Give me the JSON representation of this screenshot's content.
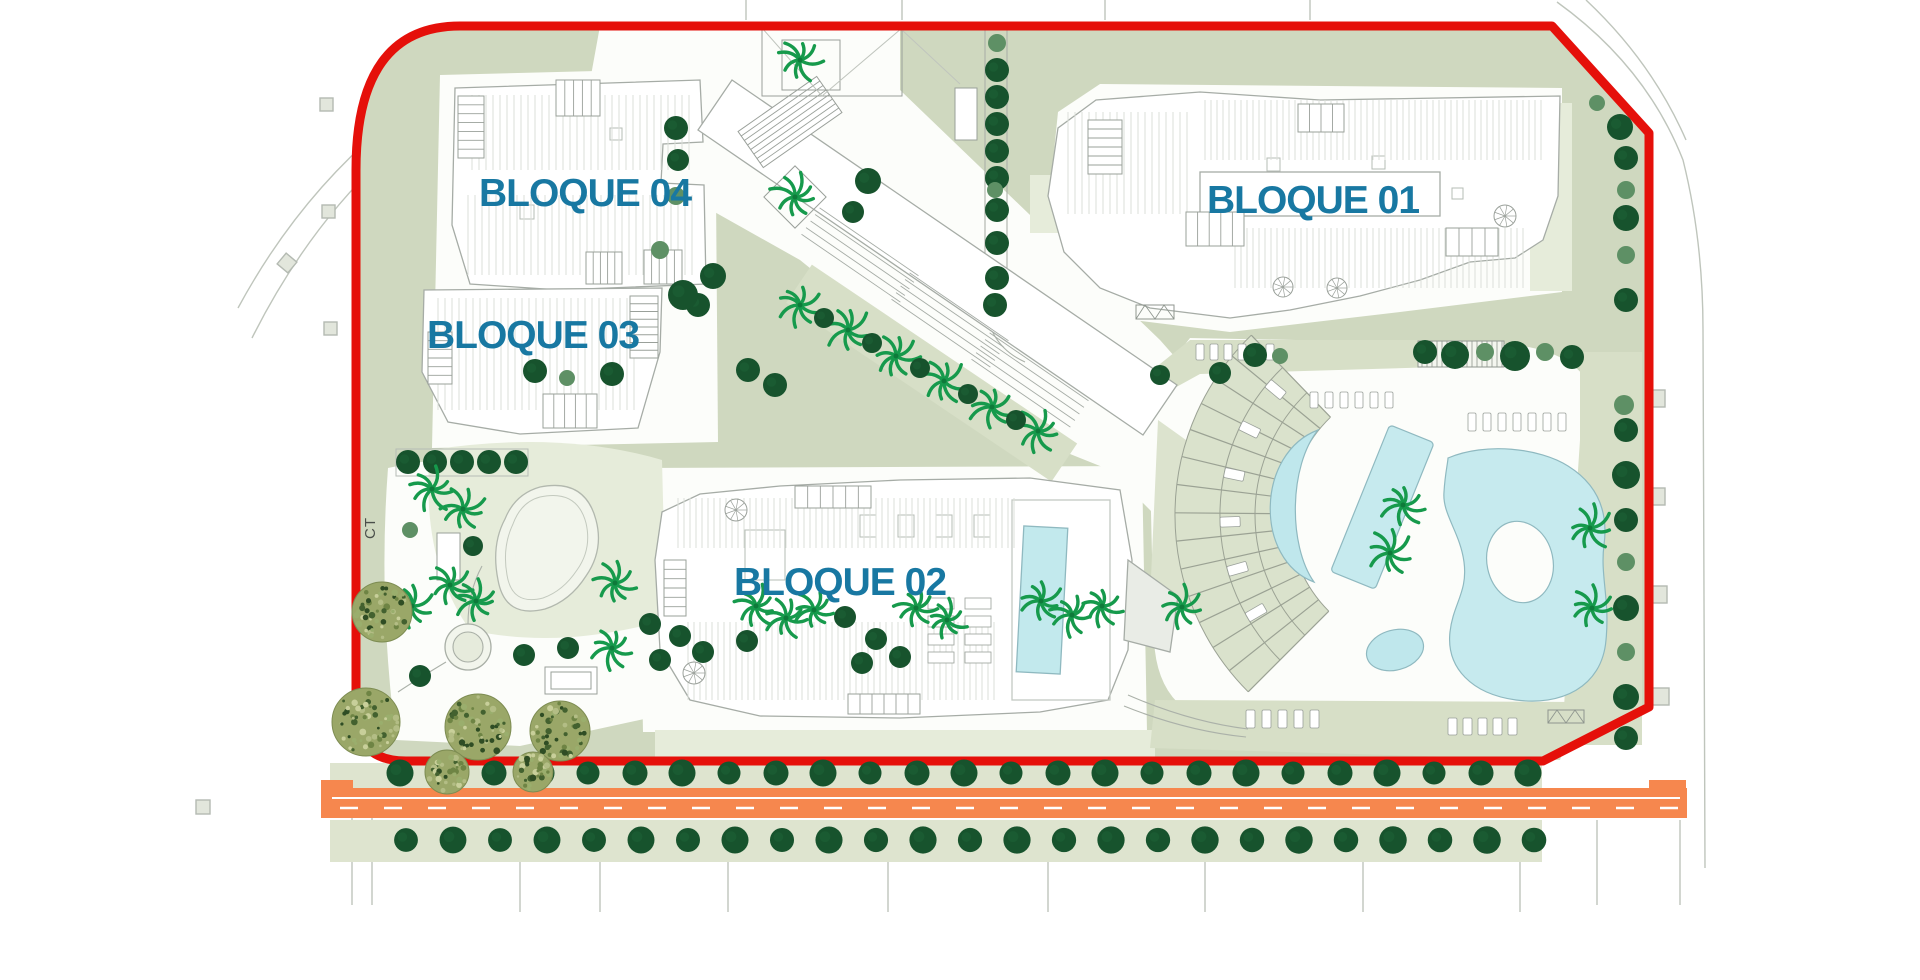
{
  "plan": {
    "type": "residential-masterplan-site-plan",
    "blocks": [
      {
        "id": "bloque-01",
        "label": "BLOQUE 01"
      },
      {
        "id": "bloque-02",
        "label": "BLOQUE 02"
      },
      {
        "id": "bloque-03",
        "label": "BLOQUE 03"
      },
      {
        "id": "bloque-04",
        "label": "BLOQUE 04"
      }
    ],
    "utility_label": "CT",
    "colors": {
      "block_label": "#1878A2",
      "site_boundary": "#E5100A",
      "road": "#F6874E",
      "road_line": "#FFFFFF",
      "pool_water": "#BFE7EC",
      "ground_sage": "#CFD8BF",
      "band_sage": "#D7DFC7",
      "lawn_light": "#E6ECDA",
      "tree_dark": "#17532D",
      "tree_mid": "#5E9065",
      "palm_green": "#169A4C",
      "olive_tree": "#9AA768",
      "building_fill": "#FFFFFF",
      "building_stroke": "#A6ACA6",
      "hatch": "#DBDFD9"
    }
  }
}
